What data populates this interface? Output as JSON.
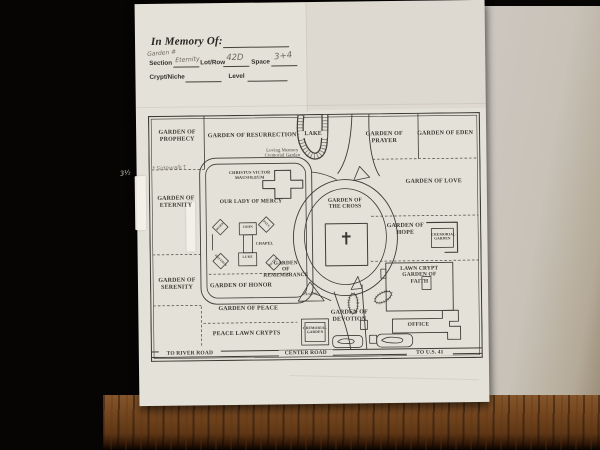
{
  "form": {
    "title": "In Memory Of:",
    "annotation_above_section": "Garden #",
    "section_label": "Section",
    "section_value": "Eternity",
    "lot_row_label": "Lot/Row",
    "lot_row_value": "42D",
    "space_label": "Space",
    "space_value": "3+4",
    "crypt_label": "Crypt/Niche",
    "level_label": "Level"
  },
  "margin_notes": {
    "sidewalk": "↑Sidewalk↑",
    "measure": "3½"
  },
  "map": {
    "cross_symbol": "✝",
    "labels": [
      {
        "text": "GARDEN OF\nPROPHECY"
      },
      {
        "text": "GARDEN OF RESURRECTION"
      },
      {
        "text": "LAKE"
      },
      {
        "text": "GARDEN OF PRAYER"
      },
      {
        "text": "GARDEN OF EDEN"
      },
      {
        "text": "Loving Memory\nCremorial Garden"
      },
      {
        "text": "GARDEN OF LOVE"
      },
      {
        "text": "GARDEN OF\nETERNITY"
      },
      {
        "text": "CHRISTUS VICTOR MAUSOLEUM"
      },
      {
        "text": "OUR LADY OF MERCY"
      },
      {
        "text": "GARDEN OF\nTHE CROSS"
      },
      {
        "text": "GARDEN OF\nHOPE"
      },
      {
        "text": "CREMORIAL\nGARDEN"
      },
      {
        "text": "LAWN CRYPT\nGARDEN OF\nFAITH"
      },
      {
        "text": "OFFICE"
      },
      {
        "text": "GARDEN OF\nSERENITY"
      },
      {
        "text": "GARDEN OF HONOR"
      },
      {
        "text": "GARDEN\nOF\nREMEMBRANCE"
      },
      {
        "text": "Angels"
      },
      {
        "text": "GARDEN OF PEACE"
      },
      {
        "text": "PEACE LAWN CRYPTS"
      },
      {
        "text": "CREMORIAL\nGARDEN"
      },
      {
        "text": "GARDEN OF\nDEVOTION"
      },
      {
        "text": "TO RIVER ROAD"
      },
      {
        "text": "CENTER ROAD"
      },
      {
        "text": "TO U.S. 41"
      },
      {
        "text": "JOHN"
      },
      {
        "text": "CHAPEL"
      },
      {
        "text": "LUKE"
      },
      {
        "text": "MARK"
      },
      {
        "text": "PAUL"
      },
      {
        "text": "MATTHEW"
      },
      {
        "text": "PETER"
      }
    ]
  }
}
